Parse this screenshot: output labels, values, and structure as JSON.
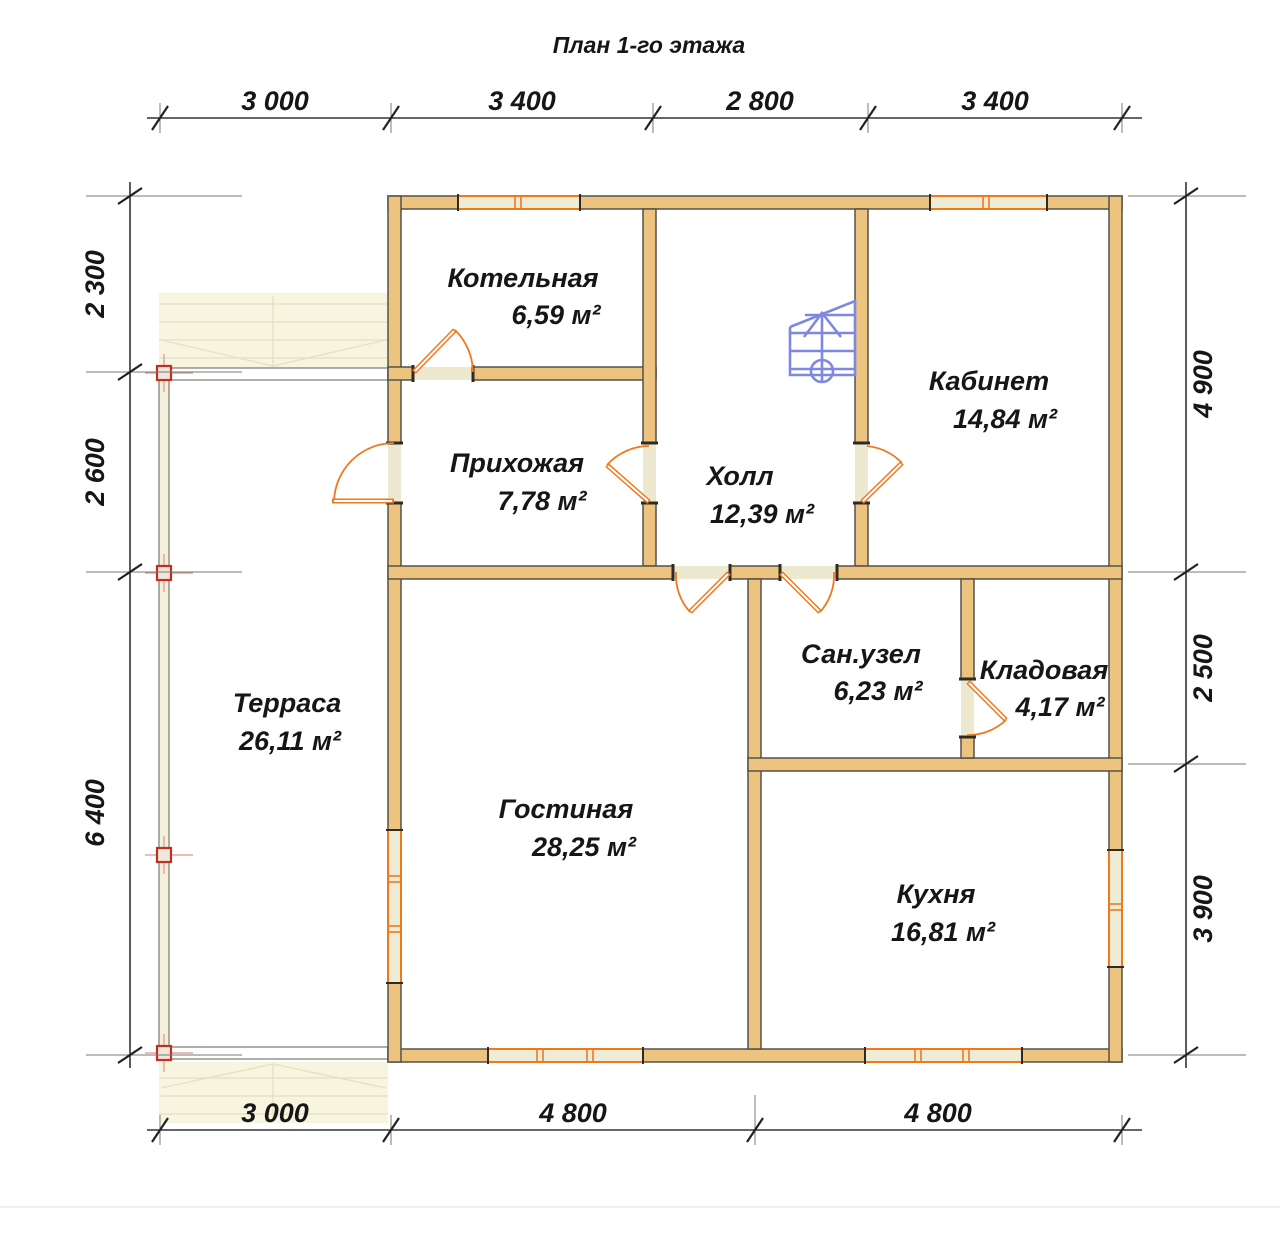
{
  "title": "План 1-го этажа",
  "rooms": [
    {
      "name": "Котельная",
      "area": "6,59 м²"
    },
    {
      "name": "Прихожая",
      "area": "7,78 м²"
    },
    {
      "name": "Холл",
      "area": "12,39 м²"
    },
    {
      "name": "Кабинет",
      "area": "14,84 м²"
    },
    {
      "name": "Сан.узел",
      "area": "6,23 м²"
    },
    {
      "name": "Кладовая",
      "area": "4,17 м²"
    },
    {
      "name": "Гостиная",
      "area": "28,25 м²"
    },
    {
      "name": "Кухня",
      "area": "16,81 м²"
    },
    {
      "name": "Терраса",
      "area": "26,11 м²"
    }
  ],
  "dimensions": {
    "top": [
      "3 000",
      "3 400",
      "2 800",
      "3 400"
    ],
    "bottom": [
      "3 000",
      "4 800",
      "4 800"
    ],
    "left": [
      "2 300",
      "2 600",
      "6 400"
    ],
    "right": [
      "4 900",
      "2 500",
      "3 900"
    ]
  },
  "colors": {
    "wall_fill": "#ecc480",
    "wall_outline": "#55514a",
    "door_window_accent": "#f0791e",
    "window_fill": "#efecd6",
    "stairs_blue": "#7e88e0",
    "post_red": "#c03020",
    "dimension_line": "#333333",
    "text": "#161616",
    "background": "#ffffff"
  }
}
